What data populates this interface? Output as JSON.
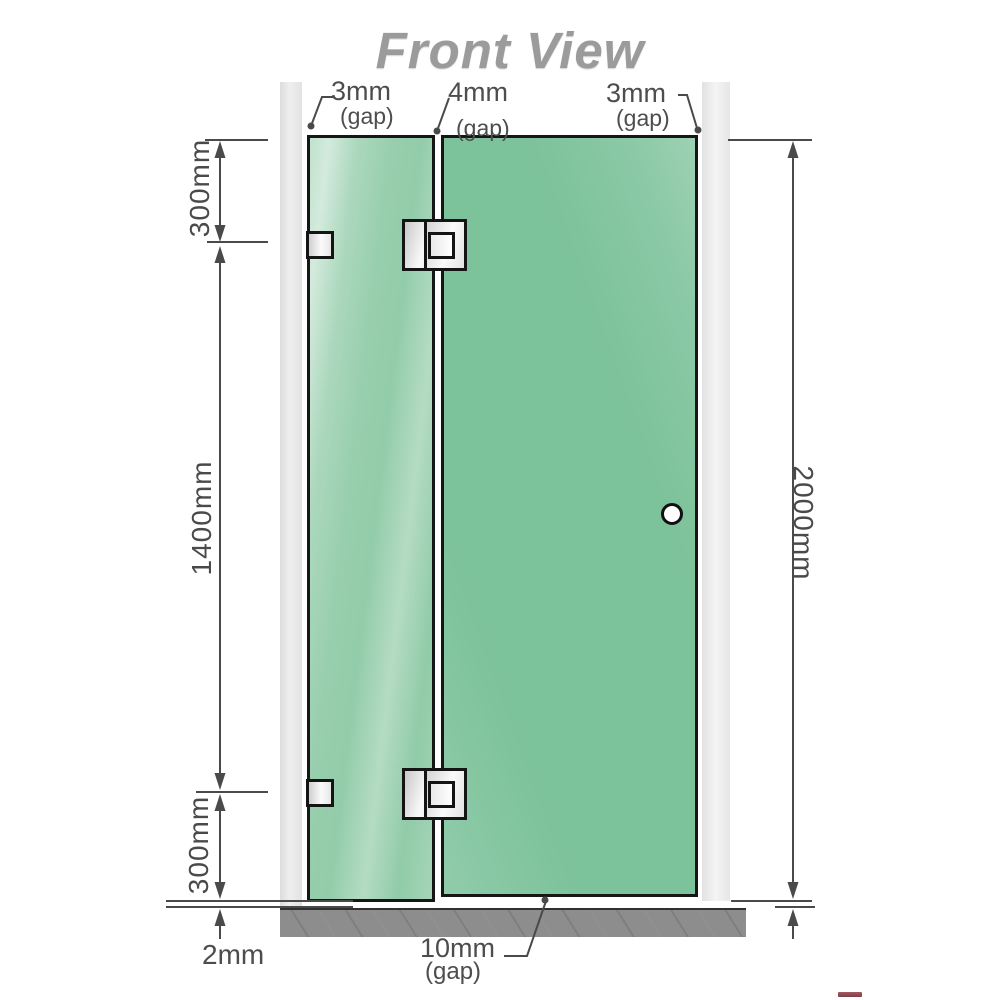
{
  "title": "Front View",
  "top_gaps": {
    "left": {
      "value": "3mm",
      "label": "(gap)"
    },
    "center": {
      "value": "4mm",
      "label": "(gap)"
    },
    "right": {
      "value": "3mm",
      "label": "(gap)"
    }
  },
  "side_dimensions": {
    "left_top": "300mm",
    "left_middle": "1400mm",
    "left_bottom": "300mm",
    "right_overall": "2000mm"
  },
  "bottom_annotations": {
    "floor_clearance": "2mm",
    "door_gap": {
      "value": "10mm",
      "label": "(gap)"
    }
  },
  "colors": {
    "glass_green": "#7cc29a",
    "glass_fixed_green": "#8cc9a4",
    "wall_gray": "#e7e7e7",
    "floor_gray": "#8d8d8d",
    "dimension_gray": "#4a4a4a",
    "title_gray": "#9b9b9b",
    "hardware_outline": "#141414"
  }
}
